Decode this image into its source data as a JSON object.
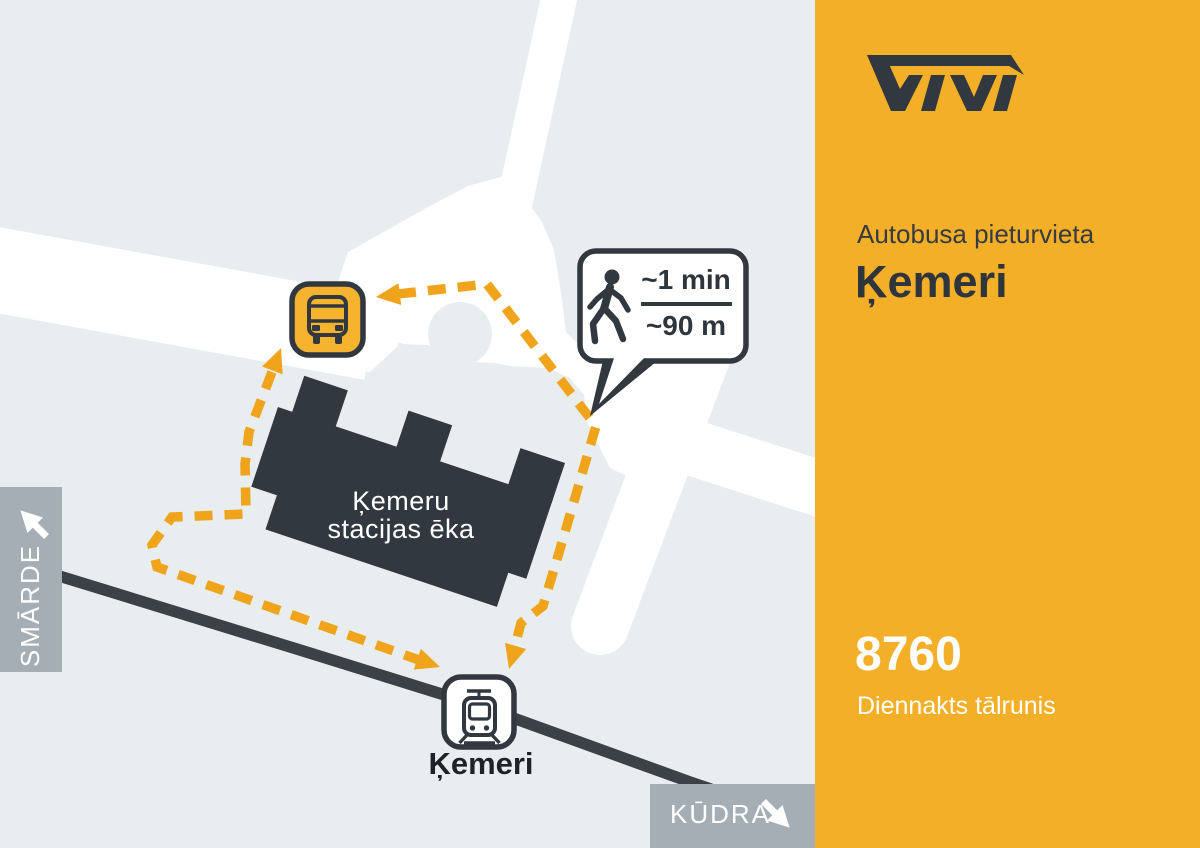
{
  "colors": {
    "sidebar_bg": "#F4AF28",
    "map_bg": "#E8EDF0",
    "road": "#FFFFFF",
    "dark": "#31383F",
    "path_yellow": "#F0A41C",
    "bus_fill": "#F5B32E",
    "sign_gray": "#A5AEB5",
    "railway": "#3A4147",
    "text_light": "#FFFFFF",
    "title_dark": "#2E353C"
  },
  "map": {
    "building": {
      "line1": "Ķemeru",
      "line2": "stacijas ēka"
    },
    "station_label": "Ķemeri",
    "walk_bubble": {
      "time": "~1 min",
      "distance": "~90 m",
      "icon": "walking-person-icon"
    },
    "signs": {
      "left": {
        "label": "SMĀRDE",
        "icon": "arrow-up-left-icon"
      },
      "bottom": {
        "label": "KŪDRA",
        "icon": "arrow-down-right-icon"
      }
    },
    "icons": {
      "bus_stop": "bus-icon",
      "train_station": "train-icon"
    }
  },
  "sidebar": {
    "logo": "Vivi",
    "subtitle": "Autobusa pieturvieta",
    "title": "Ķemeri",
    "phone": "8760",
    "phone_label": "Diennakts tālrunis"
  }
}
